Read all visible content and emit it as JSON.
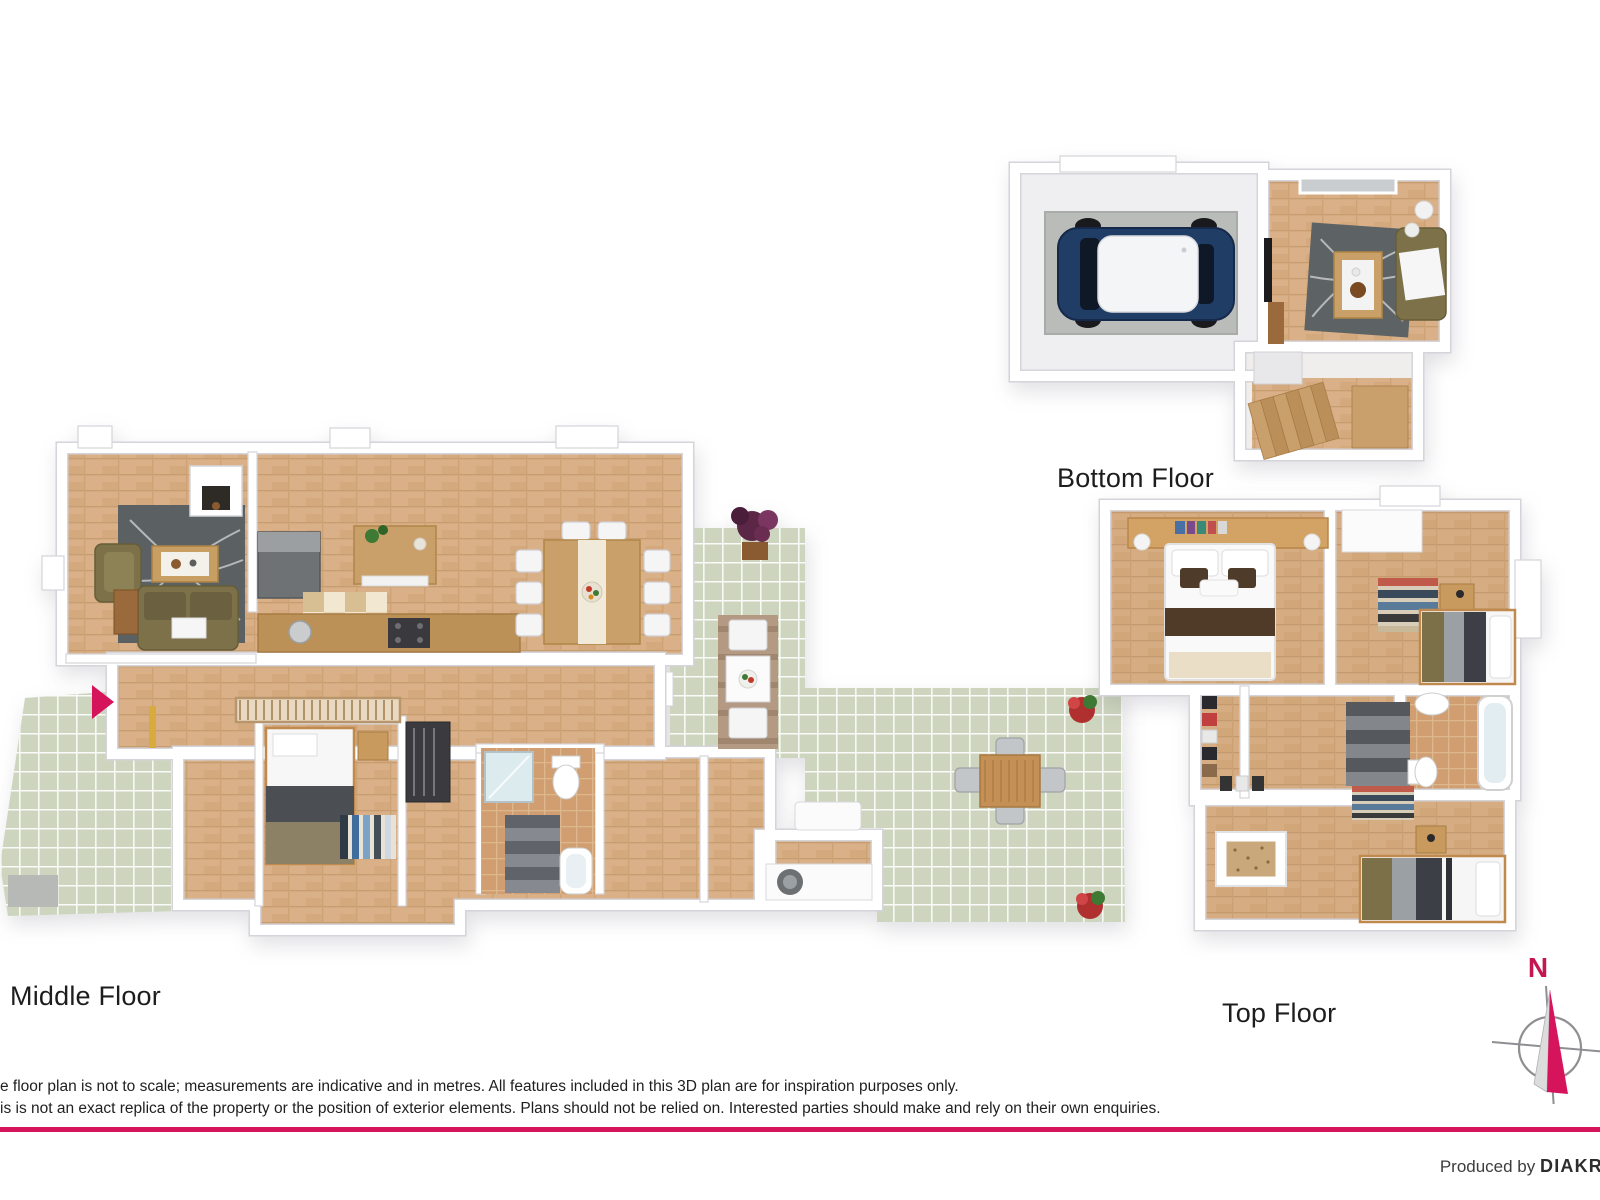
{
  "page": {
    "background": "#ffffff",
    "accent_color": "#d5145c"
  },
  "floors": {
    "middle": {
      "label": "Middle Floor",
      "features": [
        "living-room",
        "fireplace",
        "sofa",
        "armchair",
        "coffee-table",
        "patterned-rug",
        "kitchen",
        "fridge",
        "kitchen-island",
        "counter-with-sink-and-stove",
        "checkered-mat",
        "dining-table-with-chairs",
        "entrance-arrow",
        "hallway",
        "single-bedroom",
        "striped-rug",
        "wardrobe",
        "bathroom-shower-toilet-tub",
        "staircase",
        "laundry-with-washer",
        "balcony-with-bistro-set",
        "potted-plant",
        "tiled-patio-left",
        "tiled-patio-right",
        "outdoor-table-four-chairs",
        "flower-pots",
        "stair-void-railing"
      ]
    },
    "bottom": {
      "label": "Bottom Floor",
      "features": [
        "garage",
        "car",
        "concrete-floor",
        "living-room",
        "sofa",
        "coffee-table",
        "patterned-rug",
        "floor-lamp",
        "wall-tv",
        "window",
        "hallway",
        "wooden-staircase"
      ]
    },
    "top": {
      "label": "Top Floor",
      "features": [
        "master-bedroom-double-bed",
        "headboard-shelf-with-books",
        "bedside-lamps",
        "bedroom-2-single-bed",
        "striped-rug",
        "desk",
        "built-in-closet",
        "walk-in-closet-shoe-racks",
        "staircase",
        "bathroom-bathtub-sink-toilet",
        "bedroom-3-single-bed",
        "skylight",
        "nightstand",
        "hallway"
      ]
    }
  },
  "compass": {
    "north_label": "N",
    "needle_color": "#d5145c",
    "ring_color": "#8f8f93"
  },
  "disclaimer": {
    "line1": "e floor plan is not to scale; measurements are indicative and in metres. All features included in this 3D plan are for inspiration purposes only.",
    "line2": "is is not an exact replica of the property or the position of exterior elements. Plans should not be relied on. Interested parties should make and rely on their own enquiries."
  },
  "footer": {
    "produced_by_label": "Produced by ",
    "brand_visible": "DIAKR"
  },
  "palette": {
    "wood": "#d9b087",
    "wood_dark": "#c79c6e",
    "tile_green": "#cdd5bf",
    "garage_gray": "#b9bcb9",
    "rug_gray": "#5b6063",
    "sofa_olive": "#7c7148",
    "car_navy": "#203d66",
    "stair_wood": "#c99f6b",
    "bath_floor": "#d09e70",
    "wall_white": "#ffffff",
    "wall_outline": "#d4d4da"
  }
}
